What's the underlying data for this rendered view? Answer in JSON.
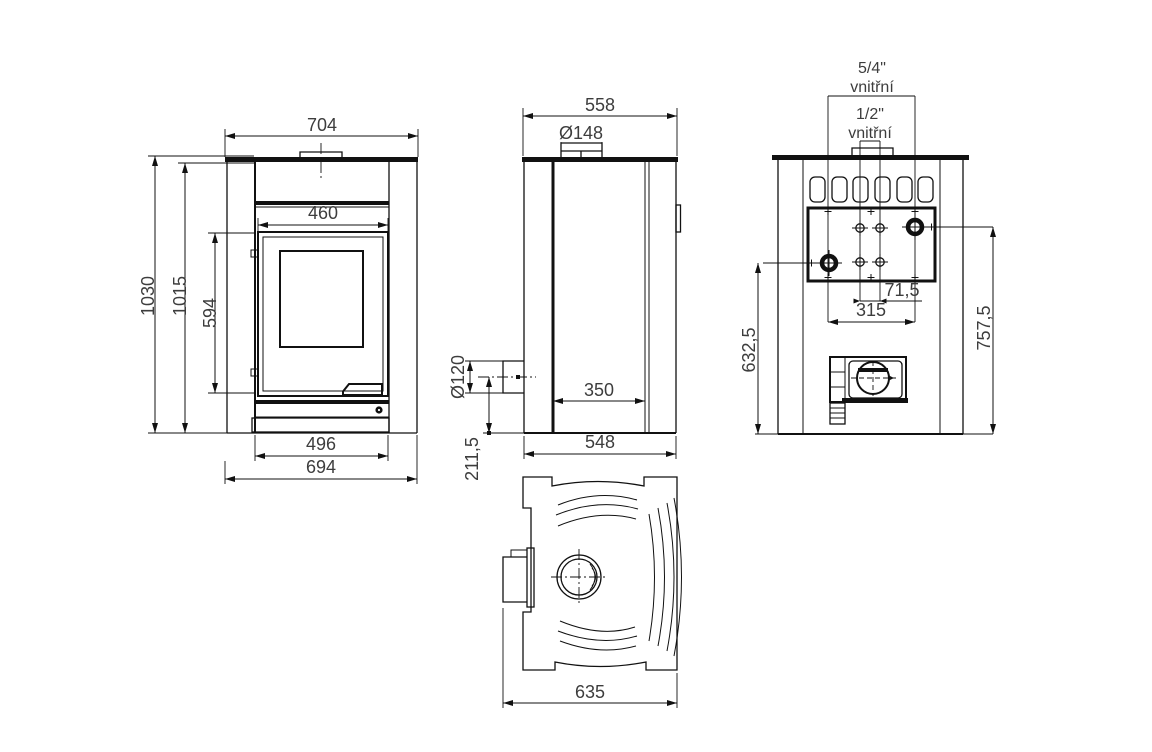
{
  "views": {
    "front": {
      "width_top": "704",
      "firebox_opening_width": "460",
      "door_height": "594",
      "total_height": "1030",
      "body_height": "1015",
      "base_inner_width": "496",
      "base_width": "694"
    },
    "side": {
      "depth_top": "558",
      "flue_diameter": "Ø148",
      "outlet_diameter": "Ø120",
      "firebox_depth": "350",
      "depth_bottom": "548",
      "outlet_axis_height": "211,5"
    },
    "rear": {
      "fitting_large": "5/4\"",
      "fitting_large_note": "vnitřní",
      "fitting_small": "1/2\"",
      "fitting_small_note": "vnitřní",
      "fitting_spacing_small": "71,5",
      "fitting_spacing_large": "315",
      "fitting_height_left": "632,5",
      "fitting_height_right": "757,5"
    },
    "top": {
      "depth_overall": "635"
    }
  },
  "colors": {
    "line": "#111111",
    "text": "#3d3d3d",
    "background": "#ffffff"
  }
}
